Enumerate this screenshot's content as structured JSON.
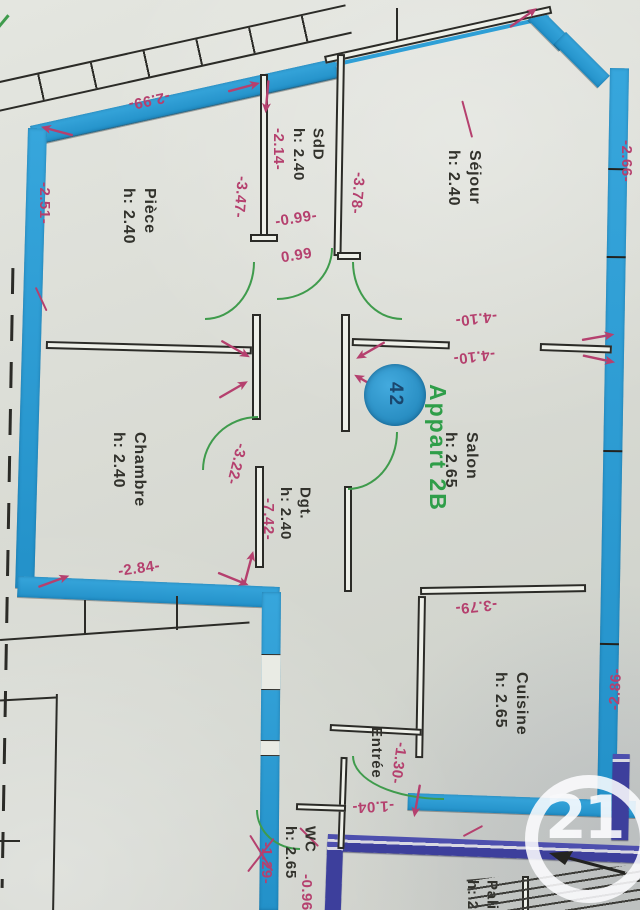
{
  "plan": {
    "apartment_label": "Appart 2B",
    "unit_badge": "42",
    "watermark": "21",
    "rooms": {
      "sejour": {
        "name": "Séjour",
        "height": "h: 2.40"
      },
      "piece": {
        "name": "Pièce",
        "height": "h: 2.40"
      },
      "sdd": {
        "name": "SdD",
        "height": "h: 2.40"
      },
      "chambre": {
        "name": "Chambre",
        "height": "h: 2.40"
      },
      "salon": {
        "name": "Salon",
        "height": "h: 2.65"
      },
      "dgt": {
        "name": "Dgt.",
        "height": "h: 2.40"
      },
      "cuisine": {
        "name": "Cuisine",
        "height": "h: 2.65"
      },
      "entree": {
        "name": "Entrée"
      },
      "wc": {
        "name": "WC",
        "height": "h: 2.65"
      },
      "palier": {
        "name": "Palier",
        "height": "h: 2."
      }
    },
    "measurements": {
      "m299": "-2.99-",
      "m251": "-2.51-",
      "m214": "-2.14-",
      "m347": "-3.47-",
      "m378": "-3.78-",
      "m099a": "-0.99-",
      "m099b": "0.99",
      "m410a": "-4.10-",
      "m410b": "-4.10-",
      "m266": "-2.66-",
      "m322": "-3.22-",
      "m742": "-7.42-",
      "m284": "-2.84-",
      "m379": "-3.79-",
      "m286": "-2.86-",
      "m130": "-1.30-",
      "m104": "-1.04-",
      "m129": "-1.29-",
      "m096": "-0.96-"
    },
    "colors": {
      "wall_marker": "#2e9fd6",
      "palier_marker": "#4547a5",
      "annotation": "#b5406e",
      "door_arc": "#3f9b4c",
      "appart_text": "#2f9e49"
    }
  }
}
